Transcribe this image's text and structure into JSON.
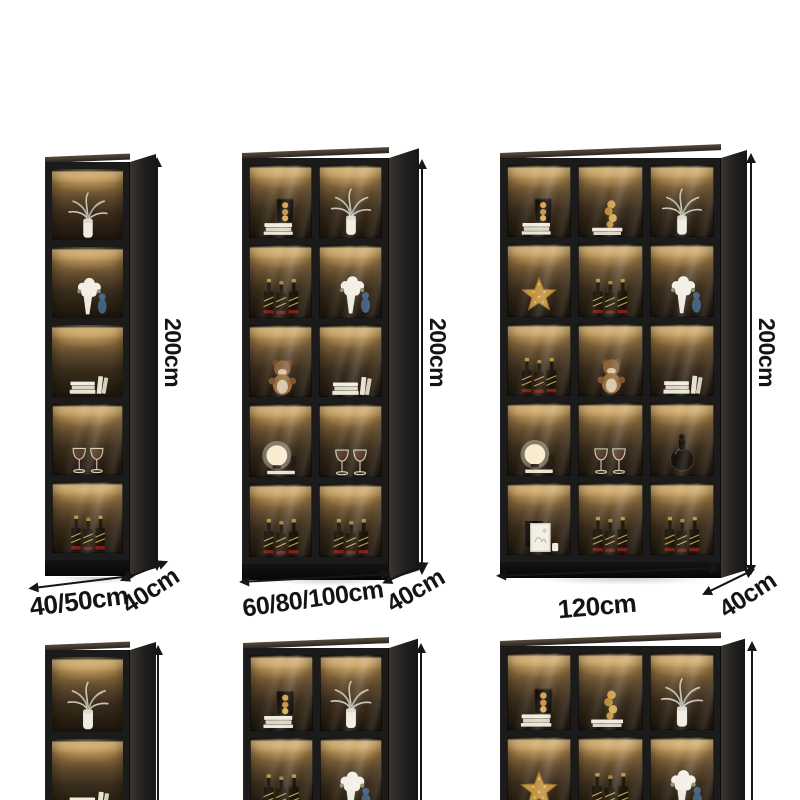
{
  "colors": {
    "background": "#ffffff",
    "cabinet_frame": "#1b1b1b",
    "shelf_glow": "#eccf97",
    "dimension_text": "#141414"
  },
  "cabinets": [
    {
      "name": "narrow-display-cabinet",
      "cols": 1,
      "glass_from": 3,
      "rows": [
        [
          "plant"
        ],
        [
          "flowers"
        ],
        [
          "books"
        ],
        [
          "glasses"
        ],
        [
          "bottles"
        ]
      ],
      "dims": {
        "height": "200cm",
        "width": "40/50cm",
        "depth": "40cm"
      }
    },
    {
      "name": "two-door-display-cabinet",
      "cols": 2,
      "glass_from": 0,
      "rows": [
        [
          "books-decor",
          "plant"
        ],
        [
          "bottles",
          "flowers"
        ],
        [
          "bear",
          "books"
        ],
        [
          "lamp",
          "glasses"
        ],
        [
          "bottles",
          "bottles"
        ]
      ],
      "dims": {
        "height": "200cm",
        "width": "60/80/100cm",
        "depth": "40cm"
      }
    },
    {
      "name": "three-door-display-cabinet",
      "cols": 3,
      "glass_from": 0,
      "rows": [
        [
          "books-decor",
          "books-gold",
          "plant"
        ],
        [
          "starfish",
          "bottles",
          "flowers"
        ],
        [
          "bottles",
          "bear",
          "books"
        ],
        [
          "lamp",
          "glasses",
          "decanter"
        ],
        [
          "frame",
          "bottles",
          "bottles"
        ]
      ],
      "dims": {
        "height": "200cm",
        "width": "120cm",
        "depth": "40cm"
      }
    },
    {
      "name": "narrow-display-cabinet-bottom",
      "cols": 1,
      "glass_from": 99,
      "rows": [
        [
          "plant"
        ],
        [
          "books"
        ]
      ]
    },
    {
      "name": "two-door-display-cabinet-bottom",
      "cols": 2,
      "glass_from": 0,
      "rows": [
        [
          "books-decor",
          "plant"
        ],
        [
          "bottles",
          "flowers"
        ]
      ]
    },
    {
      "name": "three-door-display-cabinet-bottom",
      "cols": 3,
      "glass_from": 0,
      "rows": [
        [
          "books-decor",
          "books-gold",
          "plant"
        ],
        [
          "starfish",
          "bottles",
          "flowers"
        ]
      ]
    }
  ]
}
